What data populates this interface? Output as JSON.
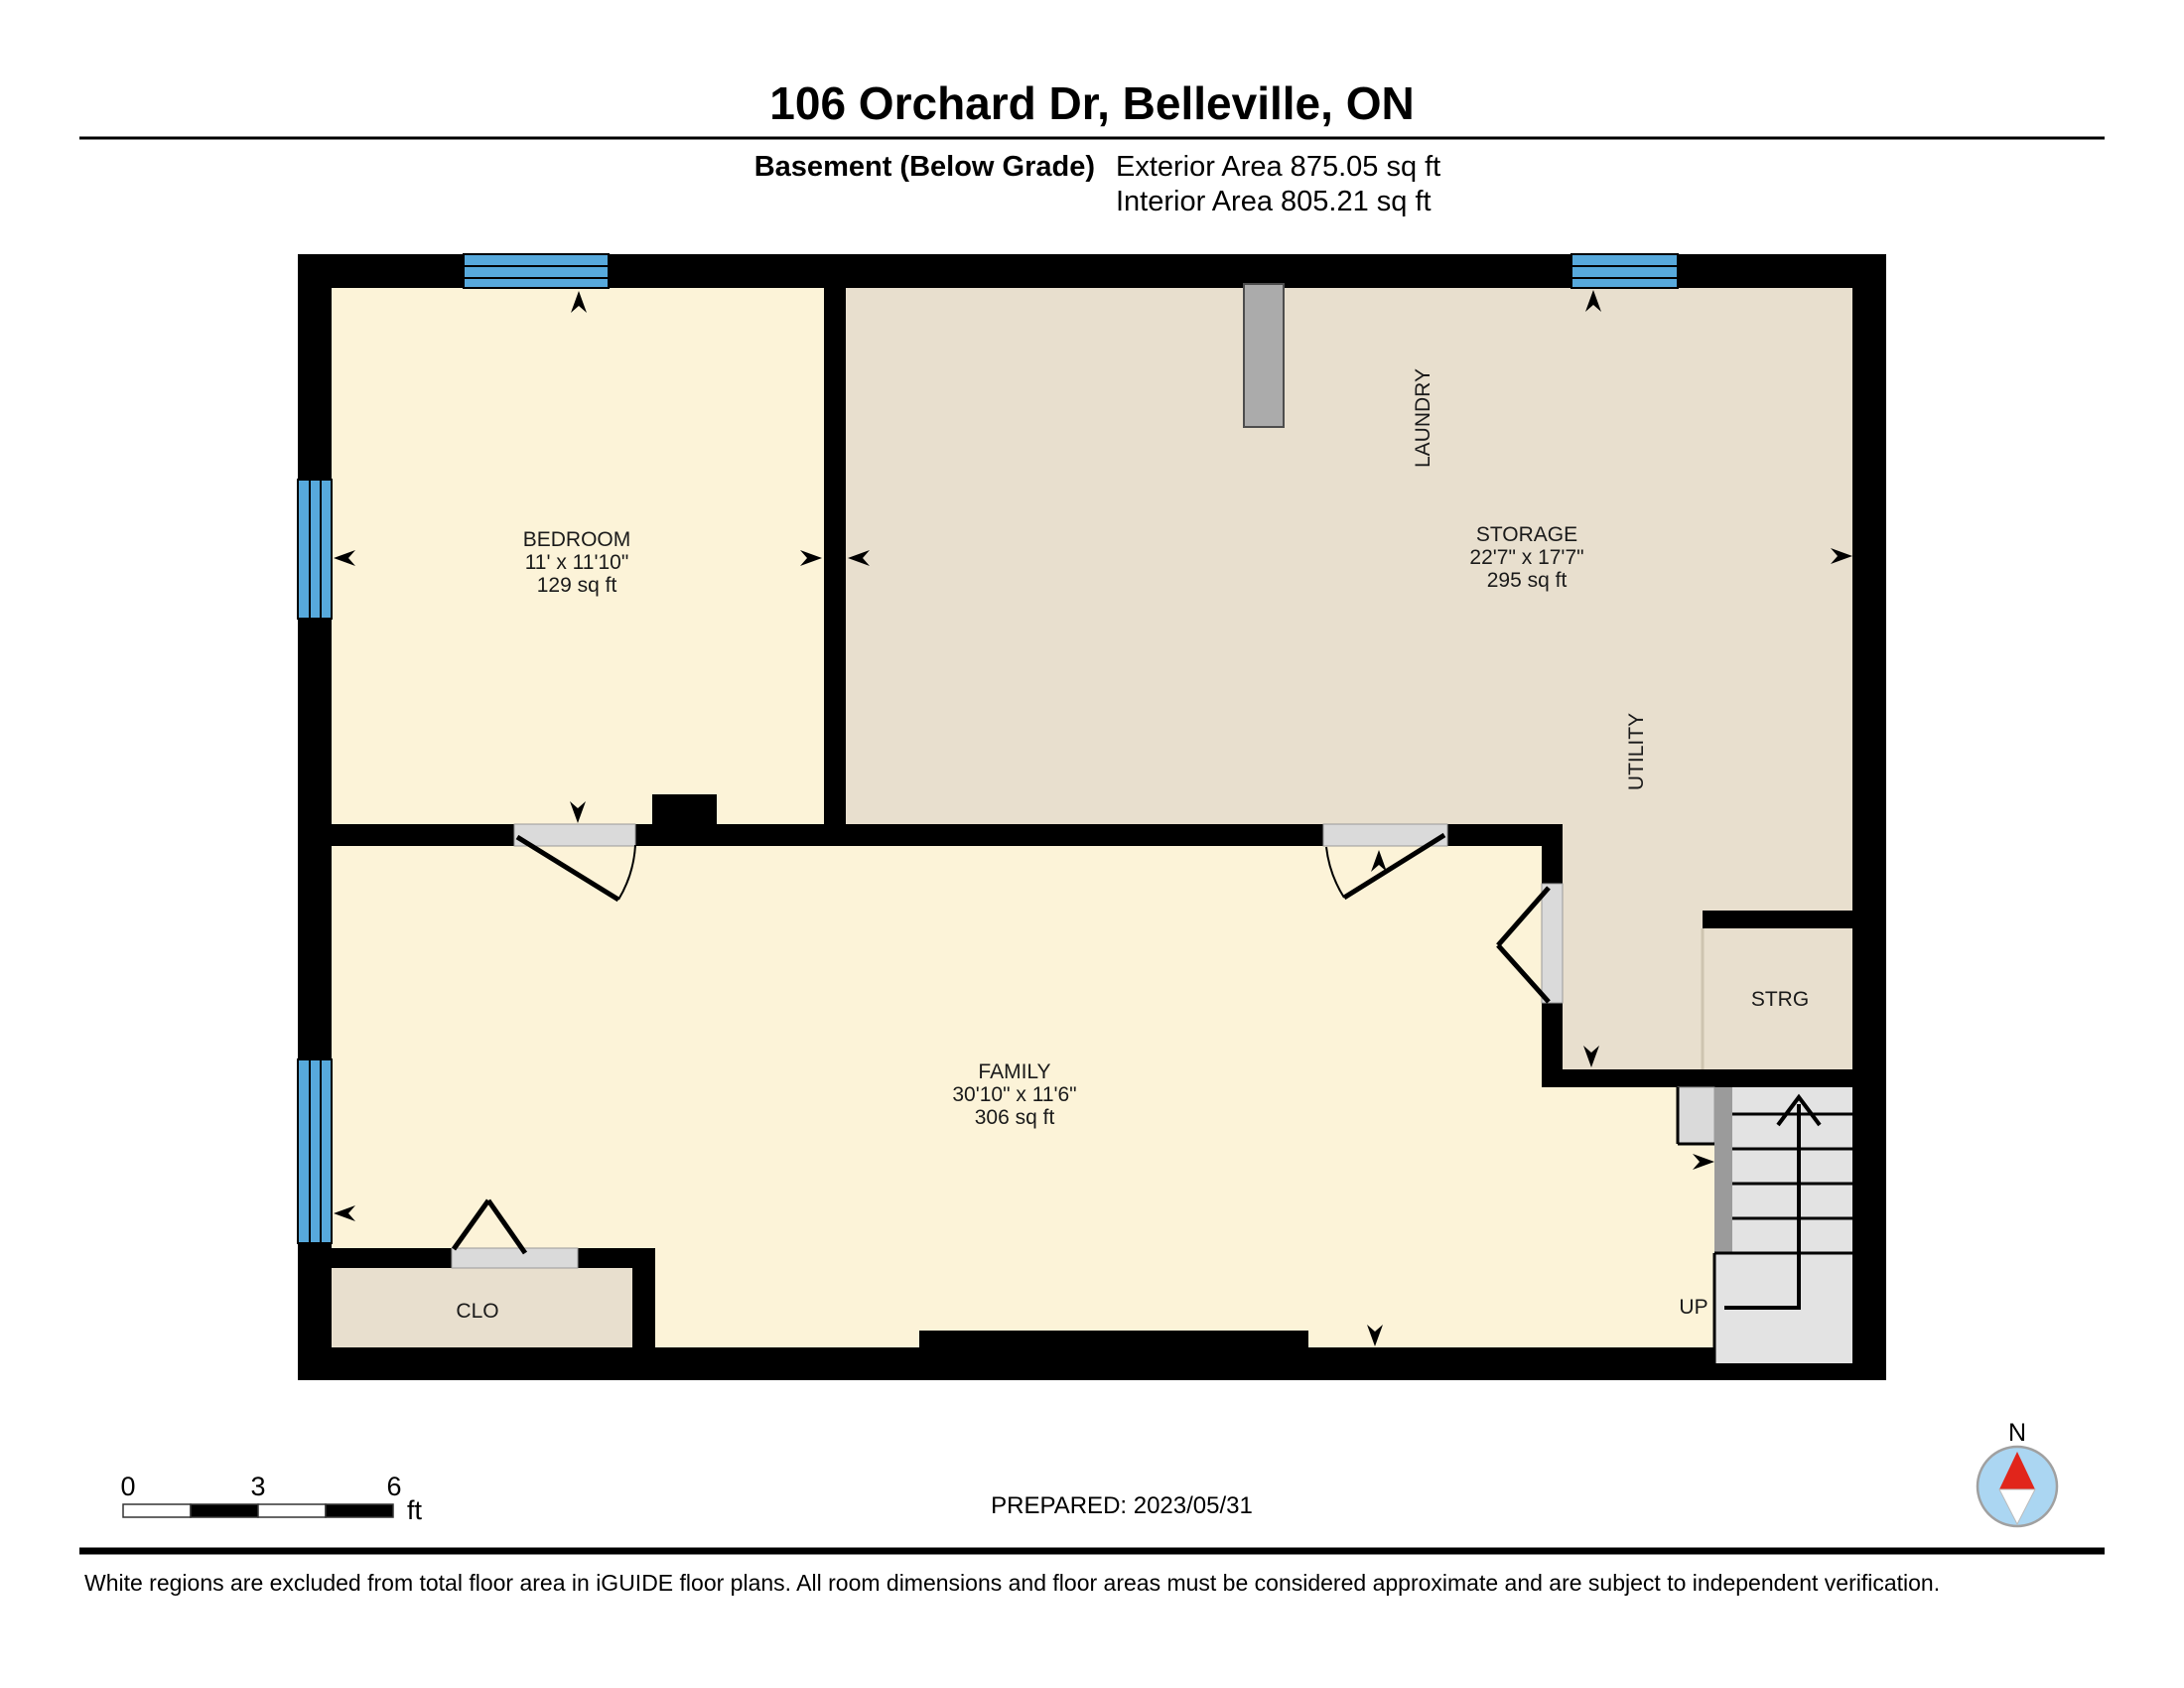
{
  "header": {
    "title": "106 Orchard Dr, Belleville, ON",
    "floor_label": "Basement (Below Grade)",
    "exterior_area": "Exterior Area 875.05 sq ft",
    "interior_area": "Interior Area 805.21 sq ft"
  },
  "rooms": {
    "bedroom": {
      "name": "BEDROOM",
      "dims": "11' x 11'10\"",
      "area": "129 sq ft"
    },
    "storage": {
      "name": "STORAGE",
      "dims": "22'7\" x 17'7\"",
      "area": "295 sq ft"
    },
    "family": {
      "name": "FAMILY",
      "dims": "30'10\" x 11'6\"",
      "area": "306 sq ft"
    },
    "laundry": {
      "name": "LAUNDRY"
    },
    "utility": {
      "name": "UTILITY"
    },
    "closet": {
      "name": "CLO"
    },
    "strg": {
      "name": "STRG"
    }
  },
  "stairs": {
    "up_label": "UP"
  },
  "scale_bar": {
    "ticks": [
      "0",
      "3",
      "6"
    ],
    "unit": "ft"
  },
  "prepared_label": "PREPARED: 2023/05/31",
  "compass": {
    "north_label": "N"
  },
  "footer": {
    "disclaimer": "White regions are excluded from total floor area in iGUIDE floor plans. All room dimensions and floor areas must be considered approximate and are subject to independent verification."
  },
  "colors": {
    "cream": "#FCF3D8",
    "beige": "#E8DFCE",
    "wall": "#000000",
    "window": "#57A9DC",
    "jamb": "#DADADA",
    "stair": "#E3E3E3",
    "stairdark": "#9B9B9B",
    "duct": "#ABABAB",
    "compassblue": "#ABD6F2",
    "compassred": "#E1251B",
    "ink": "#1a1a1a"
  }
}
